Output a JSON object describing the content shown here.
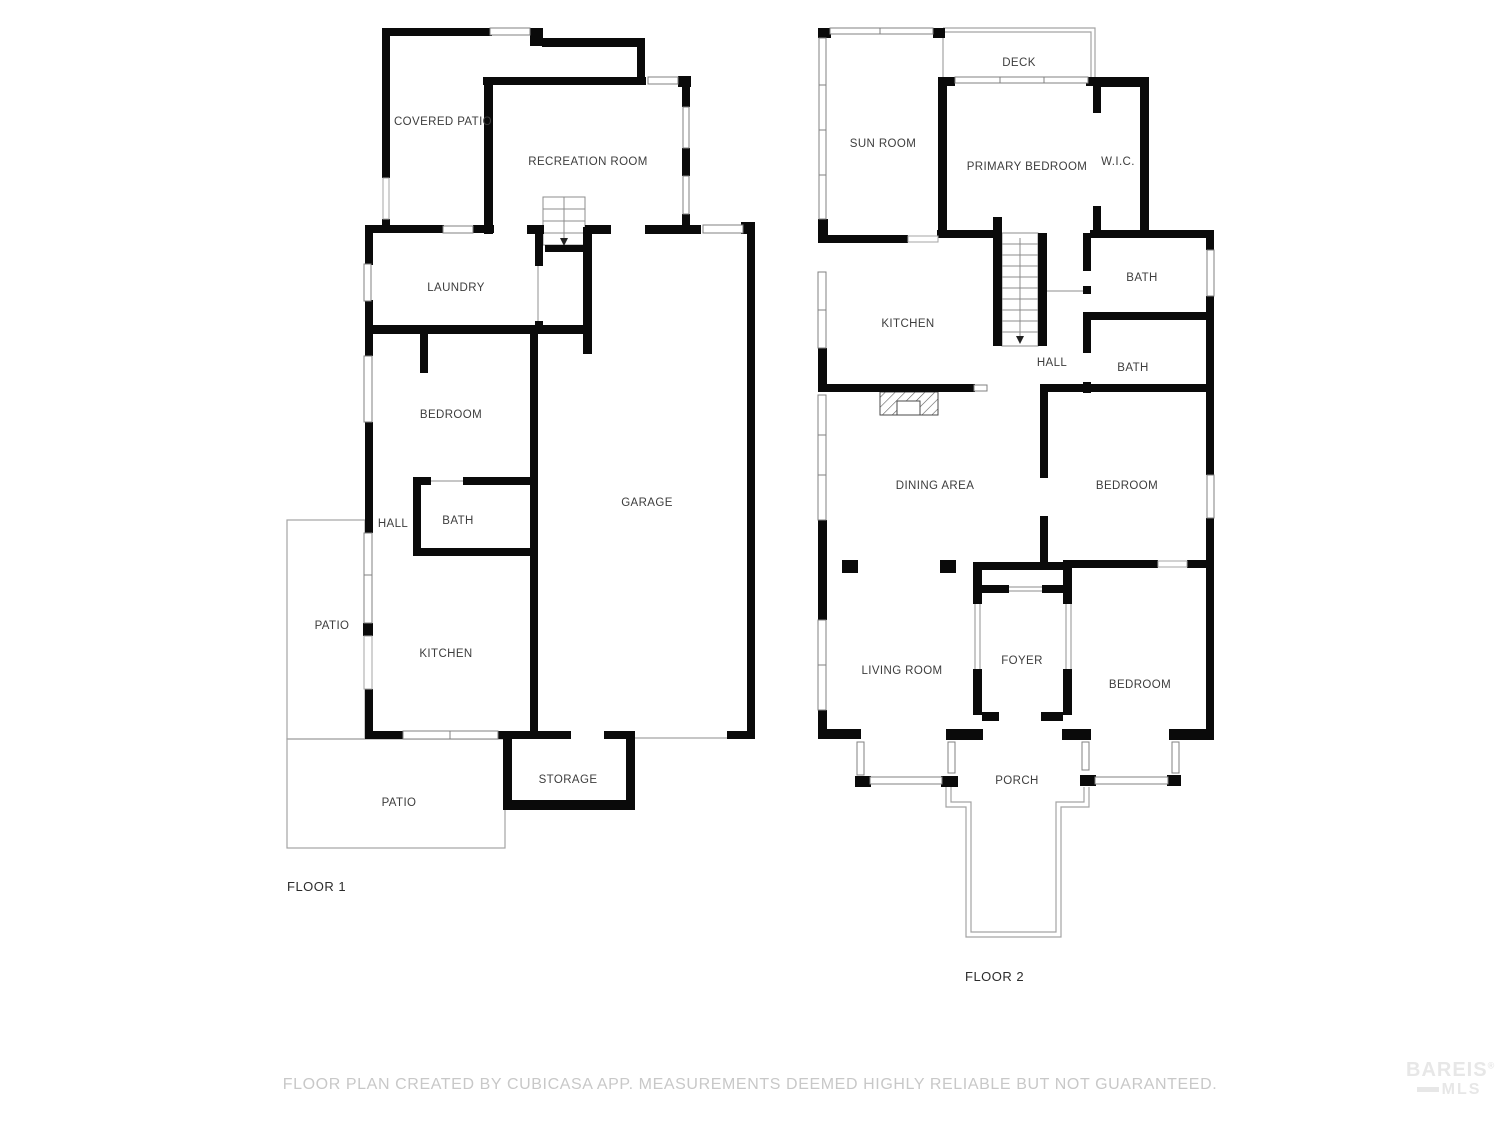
{
  "footer": {
    "disclaimer": "FLOOR PLAN CREATED BY CUBICASA APP. MEASUREMENTS DEEMED HIGHLY RELIABLE BUT NOT GUARANTEED."
  },
  "logo": {
    "name": "BAREIS",
    "registered": "®",
    "sub": "MLS"
  },
  "colors": {
    "wall": "#0a0a0a",
    "window_border": "#808080",
    "opening_border": "#a5a5a5",
    "thin_outline": "#a3a3a3",
    "label": "#3d3d3d",
    "footer_text": "#c8c8c8",
    "logo_text": "#e7e7e7"
  },
  "floor1": {
    "title": "FLOOR 1",
    "rooms": [
      {
        "label": "COVERED PATIO"
      },
      {
        "label": "RECREATION ROOM"
      },
      {
        "label": "LAUNDRY"
      },
      {
        "label": "BEDROOM"
      },
      {
        "label": "HALL"
      },
      {
        "label": "BATH"
      },
      {
        "label": "PATIO"
      },
      {
        "label": "KITCHEN"
      },
      {
        "label": "GARAGE"
      },
      {
        "label": "STORAGE"
      },
      {
        "label": "PATIO"
      }
    ]
  },
  "floor2": {
    "title": "FLOOR 2",
    "rooms": [
      {
        "label": "DECK"
      },
      {
        "label": "SUN ROOM"
      },
      {
        "label": "PRIMARY BEDROOM"
      },
      {
        "label": "W.I.C."
      },
      {
        "label": "KITCHEN"
      },
      {
        "label": "BATH"
      },
      {
        "label": "HALL"
      },
      {
        "label": "BATH"
      },
      {
        "label": "DINING AREA"
      },
      {
        "label": "BEDROOM"
      },
      {
        "label": "LIVING ROOM"
      },
      {
        "label": "FOYER"
      },
      {
        "label": "BEDROOM"
      },
      {
        "label": "PORCH"
      }
    ]
  }
}
